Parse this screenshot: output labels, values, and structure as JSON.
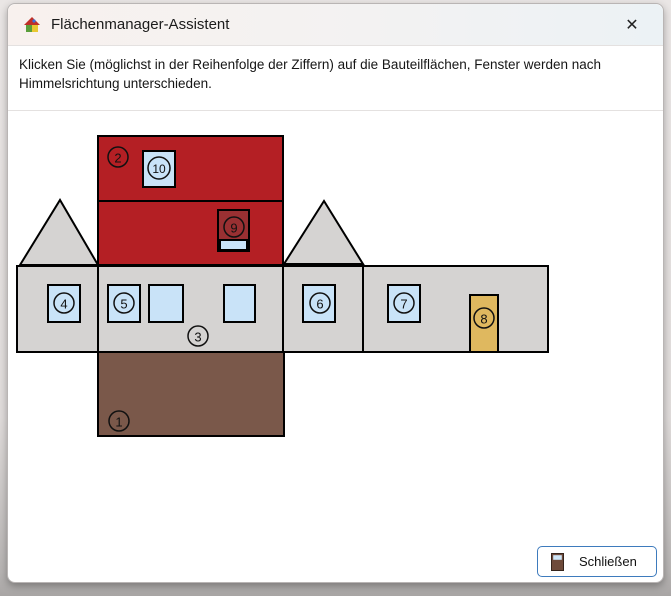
{
  "titlebar": {
    "title": "Flächenmanager-Assistent",
    "close_glyph": "✕"
  },
  "instructions": {
    "text": "Klicken Sie (möglichst in der Reihenfolge der Ziffern) auf die Bauteilflächen, Fenster werden nach Himmelsrichtung unterschieden."
  },
  "footer": {
    "close_button_label": "Schließen"
  },
  "icons": {
    "app": "house-icon",
    "titlebar_close": "close-icon",
    "button": "door-icon"
  },
  "diagram": {
    "description": "Unfolded net of a house: numbered component faces",
    "badges": [
      "1",
      "2",
      "3",
      "4",
      "5",
      "6",
      "7",
      "8",
      "9",
      "10"
    ],
    "colors": {
      "roof": "#b41f24",
      "roof_window": "#993032",
      "wall": "#d5d3d2",
      "floor": "#7a584a",
      "window": "#c9e3f8",
      "door": "#dfb85f",
      "outline": "#000000"
    }
  }
}
